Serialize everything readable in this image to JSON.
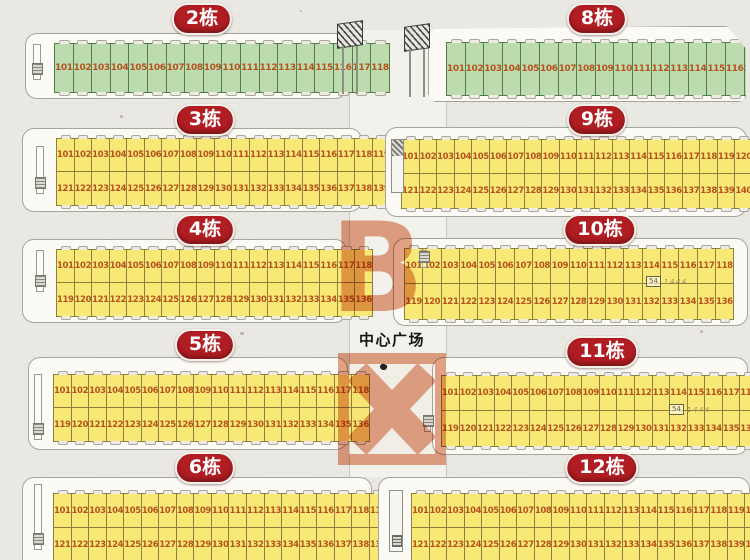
{
  "map": {
    "center_label": "中心广场",
    "watermark_top": "B",
    "watermark_bottom": "X",
    "note_box": "54",
    "note_text": "1444"
  },
  "colors": {
    "badge_red": "#b01d22",
    "stall_green_fill": "#bcdcb0",
    "stall_green_border": "#527d49",
    "stall_yellow_fill": "#f8e876",
    "stall_yellow_border": "#8f7f3a",
    "stall_number": "#b5521d",
    "watermark_salmon": "#e5a489"
  },
  "buildings": [
    {
      "id": "building-2",
      "label": "2栋",
      "variant": "green",
      "rows": [
        [
          101,
          102,
          103,
          104,
          105,
          106,
          107,
          108,
          109,
          110,
          111,
          112,
          113,
          114,
          115,
          116,
          117,
          118
        ]
      ]
    },
    {
      "id": "building-3",
      "label": "3栋",
      "variant": "yellow",
      "rows": [
        [
          101,
          102,
          103,
          104,
          105,
          106,
          107,
          108,
          109,
          110,
          111,
          112,
          113,
          114,
          115,
          116,
          117,
          118,
          119,
          120
        ],
        [
          121,
          122,
          123,
          124,
          125,
          126,
          127,
          128,
          129,
          130,
          131,
          132,
          133,
          134,
          135,
          136,
          137,
          138,
          139,
          140
        ]
      ]
    },
    {
      "id": "building-4",
      "label": "4栋",
      "variant": "yellow",
      "rows": [
        [
          101,
          102,
          103,
          104,
          105,
          106,
          107,
          108,
          109,
          110,
          111,
          112,
          113,
          114,
          115,
          116,
          117,
          118
        ],
        [
          119,
          120,
          121,
          122,
          123,
          124,
          125,
          126,
          127,
          128,
          129,
          130,
          131,
          132,
          133,
          134,
          135,
          136
        ]
      ]
    },
    {
      "id": "building-5",
      "label": "5栋",
      "variant": "yellow",
      "rows": [
        [
          101,
          102,
          103,
          104,
          105,
          106,
          107,
          108,
          109,
          110,
          111,
          112,
          113,
          114,
          115,
          116,
          117,
          118
        ],
        [
          119,
          120,
          121,
          122,
          123,
          124,
          125,
          126,
          127,
          128,
          129,
          130,
          131,
          132,
          133,
          134,
          135,
          136
        ]
      ]
    },
    {
      "id": "building-6",
      "label": "6栋",
      "variant": "yellow",
      "rows": [
        [
          101,
          102,
          103,
          104,
          105,
          106,
          107,
          108,
          109,
          110,
          111,
          112,
          113,
          114,
          115,
          116,
          117,
          118,
          119,
          120
        ],
        [
          121,
          122,
          123,
          124,
          125,
          126,
          127,
          128,
          129,
          130,
          131,
          132,
          133,
          134,
          135,
          136,
          137,
          138,
          139,
          140
        ]
      ]
    },
    {
      "id": "building-8",
      "label": "8栋",
      "variant": "green",
      "rows": [
        [
          101,
          102,
          103,
          104,
          105,
          106,
          107,
          108,
          109,
          110,
          111,
          112,
          113,
          114,
          115,
          116,
          117,
          118
        ]
      ]
    },
    {
      "id": "building-9",
      "label": "9栋",
      "variant": "yellow",
      "rows": [
        [
          101,
          102,
          103,
          104,
          105,
          106,
          107,
          108,
          109,
          110,
          111,
          112,
          113,
          114,
          115,
          116,
          117,
          118,
          119,
          120
        ],
        [
          121,
          122,
          123,
          124,
          125,
          126,
          127,
          128,
          129,
          130,
          131,
          132,
          133,
          134,
          135,
          136,
          137,
          138,
          139,
          140
        ]
      ]
    },
    {
      "id": "building-10",
      "label": "10栋",
      "variant": "yellow",
      "note": true,
      "rows": [
        [
          101,
          102,
          103,
          104,
          105,
          106,
          107,
          108,
          109,
          110,
          111,
          112,
          113,
          114,
          115,
          116,
          117,
          118
        ],
        [
          119,
          120,
          121,
          122,
          123,
          124,
          125,
          126,
          127,
          128,
          129,
          130,
          131,
          132,
          133,
          134,
          135,
          136
        ]
      ]
    },
    {
      "id": "building-11",
      "label": "11栋",
      "variant": "yellow",
      "note": true,
      "rows": [
        [
          101,
          102,
          103,
          104,
          105,
          106,
          107,
          108,
          109,
          110,
          111,
          112,
          113,
          114,
          115,
          116,
          117,
          118
        ],
        [
          119,
          120,
          121,
          122,
          123,
          124,
          125,
          126,
          127,
          128,
          129,
          130,
          131,
          132,
          133,
          134,
          135,
          136
        ]
      ]
    },
    {
      "id": "building-12",
      "label": "12栋",
      "variant": "yellow",
      "rows": [
        [
          101,
          102,
          103,
          104,
          105,
          106,
          107,
          108,
          109,
          110,
          111,
          112,
          113,
          114,
          115,
          116,
          117,
          118,
          119,
          120
        ],
        [
          121,
          122,
          123,
          124,
          125,
          126,
          127,
          128,
          129,
          130,
          131,
          132,
          133,
          134,
          135,
          136,
          137,
          138,
          139,
          140
        ]
      ]
    }
  ]
}
